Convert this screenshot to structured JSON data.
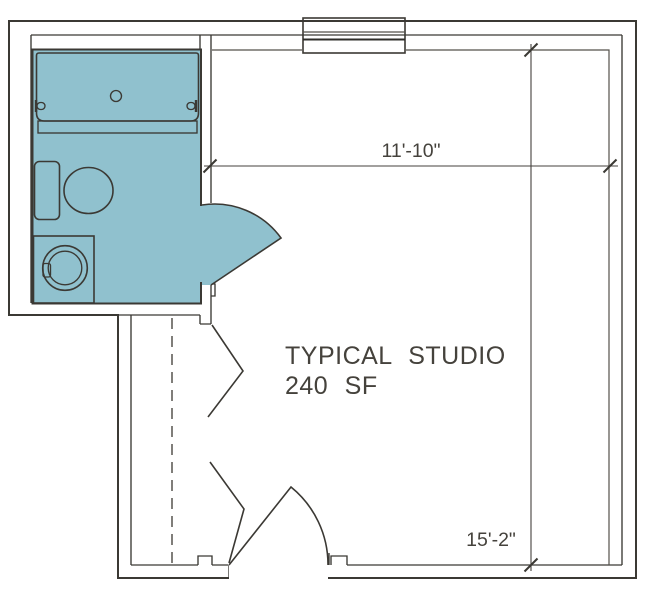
{
  "plan": {
    "room_label": "TYPICAL STUDIO",
    "area_label": "240 SF",
    "width_dimension": "11'-10\"",
    "height_dimension": "15'-2\""
  },
  "colors": {
    "background": "#FFFFFF",
    "floor": "#FBE7C4",
    "wet_area": "#90C1CE",
    "outline": "#3B3934",
    "thin_line": "#55524B",
    "text": "#45423C"
  },
  "fixtures": {
    "bathtub": "bathtub",
    "toilet": "toilet",
    "washer": "washer-dryer",
    "window": "window",
    "closet": "closet-rod-dashed",
    "bifold": "bifold-doors",
    "bath_door": "bathroom-door-swing",
    "entry_door": "entry-door-swing"
  }
}
